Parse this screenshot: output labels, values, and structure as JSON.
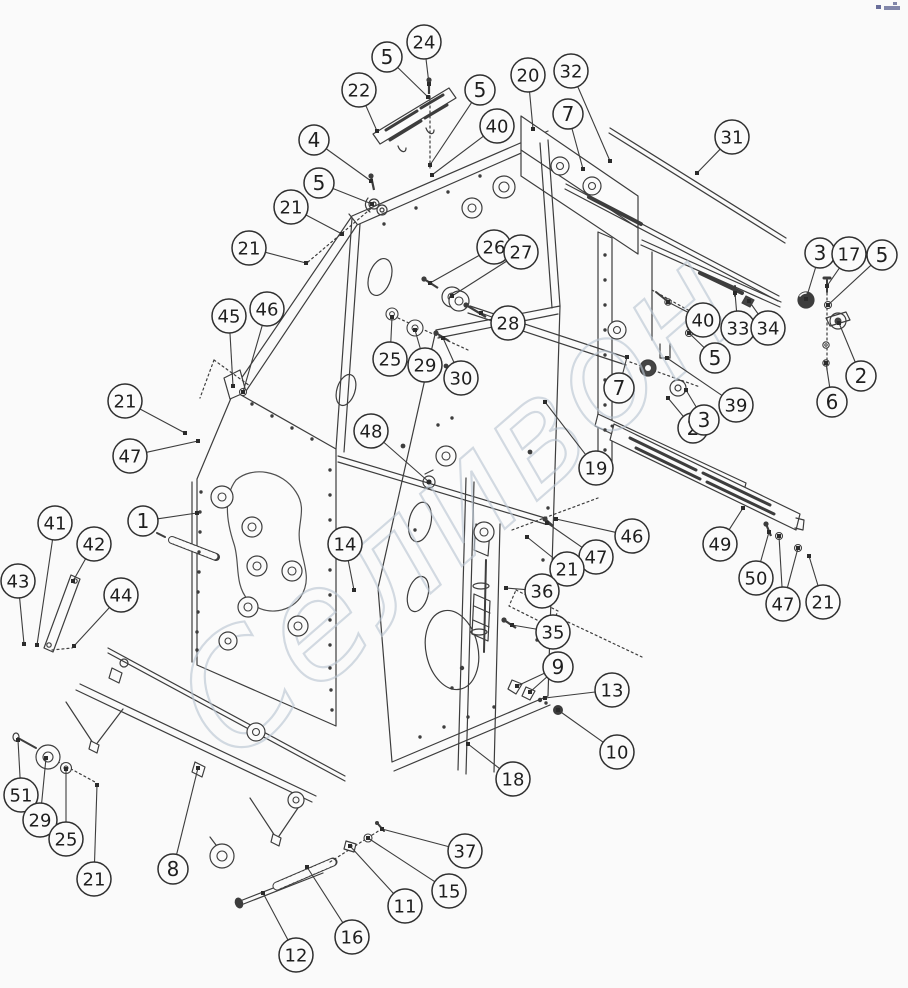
{
  "diagram": {
    "background": "#fafafa",
    "line_color": "#3d3d3d",
    "balloon": {
      "stroke": "#2f2f2f",
      "fill": "#fbfbfb",
      "text_color": "#1f1f1f"
    },
    "watermark": {
      "text": "Селивон",
      "color": "#b9c5d2",
      "opacity": 0.62
    },
    "corner_mark_color": "#4f5588",
    "callouts": [
      {
        "n": "24",
        "c": [
          424,
          42
        ],
        "t": [
          [
            429,
            84
          ]
        ]
      },
      {
        "n": "5",
        "c": [
          387,
          57
        ],
        "t": [
          [
            428,
            97
          ]
        ]
      },
      {
        "n": "22",
        "c": [
          359,
          90
        ],
        "t": [
          [
            377,
            131
          ]
        ]
      },
      {
        "n": "5",
        "c": [
          480,
          90
        ],
        "t": [
          [
            430,
            165
          ]
        ]
      },
      {
        "n": "40",
        "c": [
          497,
          126
        ],
        "t": [
          [
            432,
            175
          ]
        ]
      },
      {
        "n": "20",
        "c": [
          528,
          75
        ],
        "t": [
          [
            533,
            129
          ]
        ]
      },
      {
        "n": "32",
        "c": [
          571,
          71
        ],
        "t": [
          [
            610,
            161
          ]
        ]
      },
      {
        "n": "7",
        "c": [
          568,
          114
        ],
        "t": [
          [
            583,
            169
          ]
        ]
      },
      {
        "n": "31",
        "c": [
          732,
          137
        ],
        "t": [
          [
            697,
            173
          ]
        ]
      },
      {
        "n": "4",
        "c": [
          314,
          140
        ],
        "t": [
          [
            371,
            181
          ]
        ]
      },
      {
        "n": "5",
        "c": [
          319,
          183
        ],
        "t": [
          [
            372,
            204
          ]
        ]
      },
      {
        "n": "21",
        "c": [
          291,
          207
        ],
        "t": [
          [
            342,
            234
          ]
        ]
      },
      {
        "n": "21",
        "c": [
          249,
          248
        ],
        "t": [
          [
            306,
            263
          ]
        ]
      },
      {
        "n": "26",
        "c": [
          494,
          247
        ],
        "t": [
          [
            430,
            283
          ]
        ]
      },
      {
        "n": "27",
        "c": [
          521,
          252
        ],
        "t": [
          [
            452,
            296
          ]
        ]
      },
      {
        "n": "28",
        "c": [
          508,
          323
        ],
        "t": [
          [
            481,
            313
          ]
        ]
      },
      {
        "n": "45",
        "c": [
          229,
          316
        ],
        "t": [
          [
            233,
            386
          ]
        ]
      },
      {
        "n": "46",
        "c": [
          267,
          309
        ],
        "t": [
          [
            243,
            392
          ]
        ]
      },
      {
        "n": "25",
        "c": [
          390,
          359
        ],
        "t": [
          [
            392,
            317
          ]
        ]
      },
      {
        "n": "29",
        "c": [
          425,
          365
        ],
        "t": [
          [
            415,
            330
          ]
        ]
      },
      {
        "n": "30",
        "c": [
          461,
          378
        ],
        "t": [
          [
            443,
            338
          ]
        ]
      },
      {
        "n": "3",
        "c": [
          820,
          253
        ],
        "t": [
          [
            806,
            299
          ]
        ]
      },
      {
        "n": "17",
        "c": [
          849,
          254
        ],
        "t": [
          [
            827,
            286
          ]
        ]
      },
      {
        "n": "5",
        "c": [
          882,
          255
        ],
        "t": [
          [
            828,
            305
          ]
        ]
      },
      {
        "n": "33",
        "c": [
          738,
          328
        ],
        "t": [
          [
            735,
            293
          ]
        ]
      },
      {
        "n": "34",
        "c": [
          768,
          328
        ],
        "t": [
          [
            749,
            301
          ]
        ]
      },
      {
        "n": "2",
        "c": [
          861,
          376
        ],
        "t": [
          [
            839,
            323
          ]
        ]
      },
      {
        "n": "6",
        "c": [
          832,
          402
        ],
        "t": [
          [
            826,
            363
          ]
        ]
      },
      {
        "n": "40",
        "c": [
          703,
          320
        ],
        "t": [
          [
            668,
            302
          ]
        ]
      },
      {
        "n": "5",
        "c": [
          715,
          358
        ],
        "t": [
          [
            689,
            333
          ]
        ]
      },
      {
        "n": "39",
        "c": [
          736,
          405
        ],
        "t": [
          [
            667,
            358
          ]
        ]
      },
      {
        "n": "2",
        "c": [
          693,
          428
        ],
        "t": [
          [
            668,
            398
          ]
        ]
      },
      {
        "n": "3",
        "c": [
          704,
          420
        ],
        "t": [
          [
            686,
            390
          ]
        ]
      },
      {
        "n": "7",
        "c": [
          619,
          388
        ],
        "t": [
          [
            627,
            357
          ]
        ]
      },
      {
        "n": "19",
        "c": [
          596,
          468
        ],
        "t": [
          [
            545,
            402
          ]
        ]
      },
      {
        "n": "48",
        "c": [
          371,
          431
        ],
        "t": [
          [
            429,
            482
          ]
        ]
      },
      {
        "n": "14",
        "c": [
          345,
          544
        ],
        "t": [
          [
            354,
            590
          ]
        ]
      },
      {
        "n": "46",
        "c": [
          632,
          536
        ],
        "t": [
          [
            556,
            519
          ]
        ]
      },
      {
        "n": "47",
        "c": [
          596,
          557
        ],
        "t": [
          [
            547,
            523
          ]
        ]
      },
      {
        "n": "21",
        "c": [
          567,
          569
        ],
        "t": [
          [
            527,
            537
          ]
        ]
      },
      {
        "n": "36",
        "c": [
          542,
          591
        ],
        "t": [
          [
            506,
            588
          ]
        ]
      },
      {
        "n": "35",
        "c": [
          553,
          632
        ],
        "t": [
          [
            512,
            625
          ]
        ]
      },
      {
        "n": "9",
        "c": [
          558,
          667
        ],
        "t": [
          [
            517,
            686
          ],
          [
            530,
            692
          ]
        ]
      },
      {
        "n": "13",
        "c": [
          612,
          690
        ],
        "t": [
          [
            545,
            698
          ]
        ]
      },
      {
        "n": "10",
        "c": [
          617,
          752
        ],
        "t": [
          [
            558,
            710
          ]
        ]
      },
      {
        "n": "18",
        "c": [
          513,
          779
        ],
        "t": [
          [
            468,
            744
          ]
        ]
      },
      {
        "n": "49",
        "c": [
          720,
          544
        ],
        "t": [
          [
            743,
            508
          ]
        ]
      },
      {
        "n": "50",
        "c": [
          756,
          578
        ],
        "t": [
          [
            769,
            532
          ]
        ]
      },
      {
        "n": "47",
        "c": [
          783,
          604
        ],
        "t": [
          [
            779,
            536
          ],
          [
            798,
            548
          ]
        ]
      },
      {
        "n": "21",
        "c": [
          823,
          602
        ],
        "t": [
          [
            809,
            556
          ]
        ]
      },
      {
        "n": "51",
        "c": [
          21,
          795
        ],
        "t": [
          [
            18,
            740
          ]
        ]
      },
      {
        "n": "29",
        "c": [
          40,
          820
        ],
        "t": [
          [
            46,
            758
          ]
        ]
      },
      {
        "n": "25",
        "c": [
          66,
          839
        ],
        "t": [
          [
            66,
            769
          ]
        ]
      },
      {
        "n": "21",
        "c": [
          94,
          879
        ],
        "t": [
          [
            97,
            785
          ]
        ]
      },
      {
        "n": "8",
        "c": [
          173,
          869
        ],
        "t": [
          [
            198,
            768
          ]
        ]
      },
      {
        "n": "12",
        "c": [
          296,
          955
        ],
        "t": [
          [
            263,
            893
          ]
        ]
      },
      {
        "n": "16",
        "c": [
          352,
          937
        ],
        "t": [
          [
            307,
            867
          ]
        ]
      },
      {
        "n": "11",
        "c": [
          405,
          906
        ],
        "t": [
          [
            350,
            846
          ]
        ]
      },
      {
        "n": "15",
        "c": [
          449,
          891
        ],
        "t": [
          [
            368,
            838
          ]
        ]
      },
      {
        "n": "37",
        "c": [
          465,
          851
        ],
        "t": [
          [
            382,
            829
          ]
        ]
      },
      {
        "n": "47",
        "c": [
          130,
          456
        ],
        "t": [
          [
            198,
            441
          ]
        ]
      },
      {
        "n": "21",
        "c": [
          125,
          401
        ],
        "t": [
          [
            185,
            433
          ]
        ]
      },
      {
        "n": "1",
        "c": [
          143,
          521
        ],
        "t": [
          [
            197,
            513
          ]
        ]
      },
      {
        "n": "41",
        "c": [
          55,
          523
        ],
        "t": [
          [
            37,
            645
          ]
        ]
      },
      {
        "n": "42",
        "c": [
          94,
          544
        ],
        "t": [
          [
            73,
            581
          ]
        ]
      },
      {
        "n": "43",
        "c": [
          18,
          581
        ],
        "t": [
          [
            24,
            644
          ]
        ]
      },
      {
        "n": "44",
        "c": [
          121,
          595
        ],
        "t": [
          [
            74,
            646
          ]
        ]
      }
    ]
  }
}
